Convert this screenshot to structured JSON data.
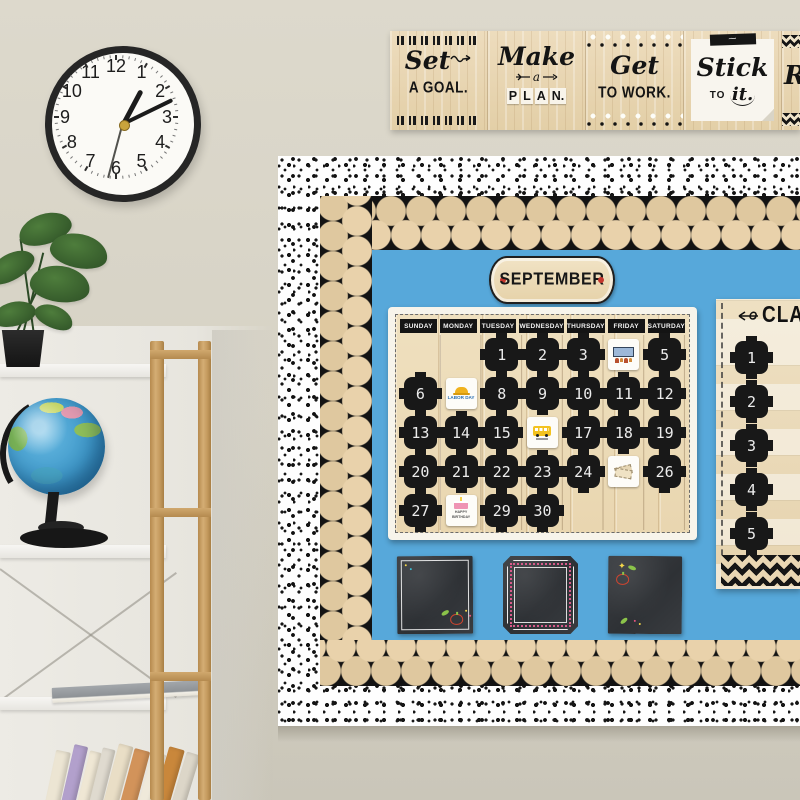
{
  "clock": {
    "numerals": [
      "12",
      "1",
      "2",
      "3",
      "4",
      "5",
      "6",
      "7",
      "8",
      "9",
      "10",
      "11"
    ],
    "hour_angle": 28,
    "minute_angle": 64,
    "second_angle": 195
  },
  "banner": {
    "panels": [
      {
        "script": "Set",
        "caps": "A GOAL."
      },
      {
        "script": "Make",
        "small": "a",
        "caps": "PLAN."
      },
      {
        "script": "Get",
        "caps": "TO WORK."
      },
      {
        "script": "Stick",
        "caps_small": "TO",
        "script2": "it."
      }
    ],
    "partial_letter": "R"
  },
  "board": {
    "month": "SEPTEMBER",
    "calendar": {
      "day_headers": [
        "SUNDAY",
        "MONDAY",
        "TUESDAY",
        "WEDNESDAY",
        "THURSDAY",
        "FRIDAY",
        "SATURDAY"
      ],
      "weeks": [
        [
          "",
          "",
          "1",
          "2",
          "3",
          {
            "sticker": "assembly",
            "label": ""
          },
          "5"
        ],
        [
          "6",
          {
            "sticker": "labor-day",
            "label": "LABOR DAY"
          },
          "8",
          "9",
          "10",
          "11",
          "12"
        ],
        [
          "13",
          "14",
          "15",
          {
            "sticker": "school-bus",
            "label": ""
          },
          "17",
          "18",
          "19"
        ],
        [
          "20",
          "21",
          "22",
          "23",
          "24",
          {
            "sticker": "tickets",
            "label": ""
          },
          "26"
        ],
        [
          "27",
          {
            "sticker": "birthday-cake",
            "label": "HAPPY BIRTHDAY"
          },
          "29",
          "30",
          "",
          "",
          ""
        ]
      ]
    },
    "side_chart": {
      "title_fragment": "CLA",
      "row_numbers": [
        "1",
        "2",
        "3",
        "4",
        "5"
      ]
    },
    "colors": {
      "board_blue": "#57a8da",
      "wood_tan": "#e8d4ad",
      "trim_black": "#161616",
      "border_white": "#ffffff"
    }
  }
}
